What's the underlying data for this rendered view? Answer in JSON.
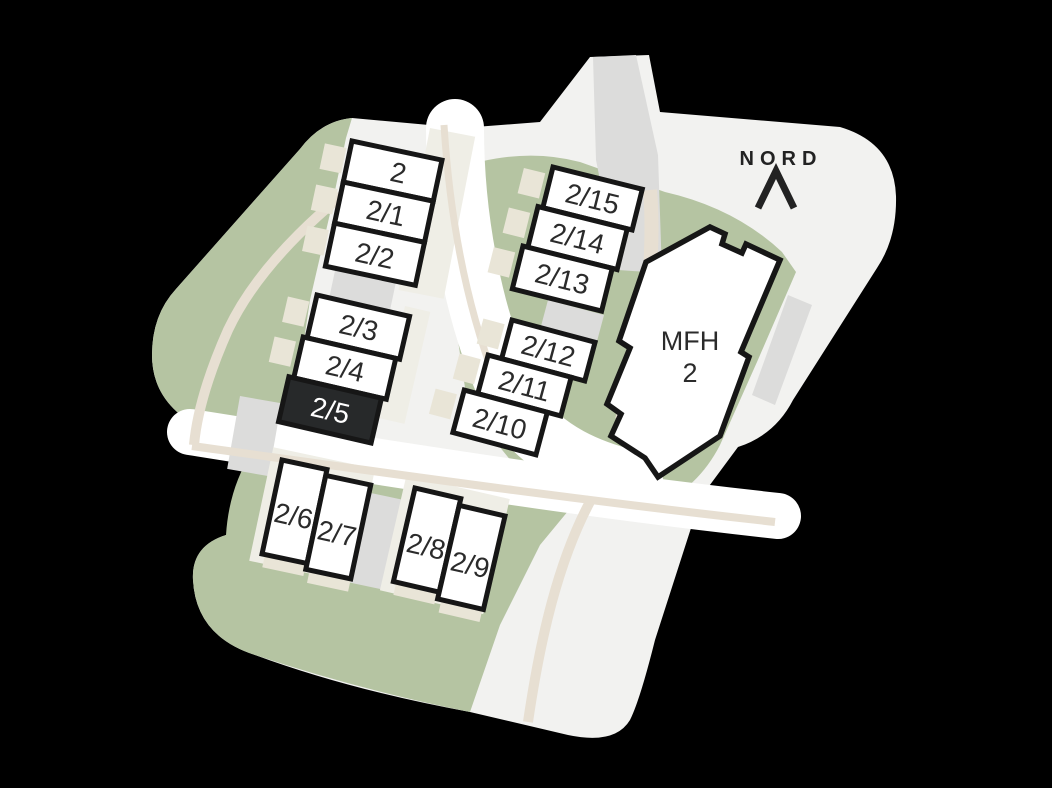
{
  "compass": {
    "north_label": "NORD"
  },
  "selected_unit": "2/5",
  "colors": {
    "background": "#000000",
    "site_base": "#f2f2f0",
    "road_white": "#ffffff",
    "green": "#b5c4a2",
    "path_beige": "#e7dfd2",
    "gray_patch": "#dcdcdb",
    "pale_patch": "#efeee6",
    "garden_beige": "#e9e5d7",
    "building_fill": "#ffffff",
    "building_stroke": "#161616",
    "selected_fill": "#27292a",
    "selected_text": "#ffffff",
    "label_color": "#2b2b2b",
    "compass_color": "#222222"
  },
  "buildings": {
    "col_a": {
      "units": [
        "2",
        "2/1",
        "2/2"
      ]
    },
    "col_b": {
      "units": [
        "2/3",
        "2/4",
        "2/5"
      ]
    },
    "col_c": {
      "units": [
        "2/15",
        "2/14",
        "2/13"
      ]
    },
    "col_d": {
      "units": [
        "2/12",
        "2/11",
        "2/10"
      ]
    },
    "pair_e": {
      "units": [
        "2/6",
        "2/7"
      ]
    },
    "pair_f": {
      "units": [
        "2/8",
        "2/9"
      ]
    },
    "mfh": {
      "line1": "MFH",
      "line2": "2"
    }
  }
}
